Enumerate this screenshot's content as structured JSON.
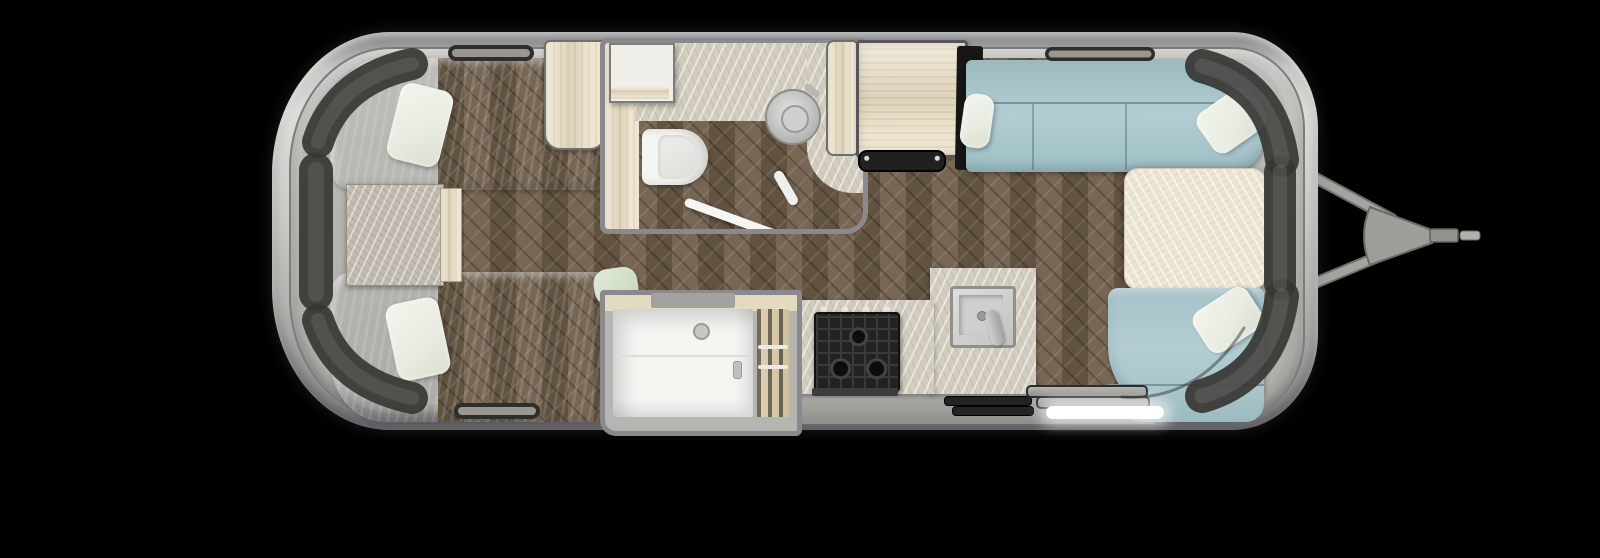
{
  "meta": {
    "description": "Top-down 3D rendered floor plan of a travel trailer (Airstream-style) with twin rear beds, center bathroom and shower, galley kitchen, and front wraparound lounge with A-frame hitch, on a black background",
    "orientation": "rear (bedroom) at left, front (hitch) at right"
  },
  "colors": {
    "background": "#000000",
    "shell_outer": "#a9a9a5",
    "shell_light": "#dcdcd8",
    "shell_dark": "#85858a",
    "wall_band": "#bcbcb8",
    "floor_wood": "#6f5d49",
    "bed_green": "#cbd7bf",
    "pillow_white": "#e9ece2",
    "marble_gray": "#c1bbb2",
    "cabinet_wood": "#e9dec4",
    "counter_marble": "#d2cdbf",
    "white_fixture": "#f5f5f2",
    "sofa_blue": "#b2cdd2",
    "table_cream": "#ece5d3",
    "stove_black": "#222220",
    "window_dark": "#3a3a37",
    "hitch_gray": "#9c9c98",
    "led_white": "#ffffff"
  },
  "furniture": {
    "bedroom": [
      "twin bed (top)",
      "twin bed (bottom)",
      "two white pillows",
      "marble nightstand",
      "wardrobe cabinet",
      "rolled blanket"
    ],
    "bathroom": [
      "vanity counter",
      "corner cabinet",
      "toilet",
      "round sink with faucet",
      "swinging door"
    ],
    "kitchen": [
      "pantry cabinet",
      "refrigerator",
      "fridge vent",
      "gas cooktop",
      "square stainless sink",
      "L-shaped marble counter",
      "drawer vents"
    ],
    "utility": [
      "shower stall with bench and shower head",
      "closet with hanger rods and clothes",
      "floor mat"
    ],
    "lounge": [
      "wraparound sofa",
      "two sofa throw pillows",
      "dining table",
      "curved bench seat",
      "bench pillow"
    ],
    "exterior": [
      "curved tinted windows",
      "roof/wall vents",
      "entry steps",
      "LED entry light strip",
      "A-frame hitch with coupler"
    ]
  }
}
